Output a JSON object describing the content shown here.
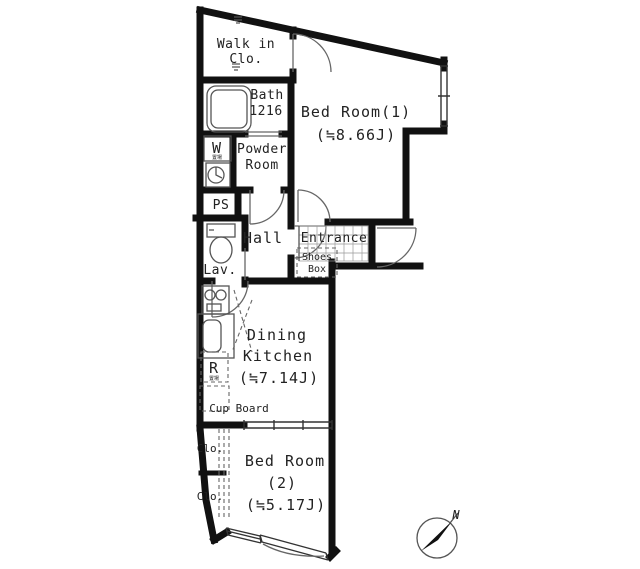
{
  "floorplan": {
    "rooms": {
      "walk_in_closet": {
        "line1": "Walk in",
        "line2": "Clo."
      },
      "bath": {
        "name": "Bath",
        "size": "1216"
      },
      "powder_room": {
        "line1": "Powder",
        "line2": "Room"
      },
      "pipe_space": "PS",
      "hall": "Hall",
      "lavatory": "Lav.",
      "entrance": "Entrance",
      "shoes_box": {
        "line1": "Shoes",
        "line2": "Box"
      },
      "bedroom1": {
        "name": "Bed Room(1)",
        "size": "(≒8.66J)"
      },
      "dining_kitchen": {
        "line1": "Dining",
        "line2": "Kitchen",
        "size": "(≒7.14J)"
      },
      "cup_board": "Cup Board",
      "bedroom2": {
        "line1": "Bed Room",
        "line2": "(2)",
        "size": "(≒5.17J)"
      },
      "closet1": "Clo.",
      "closet2": "Clo."
    },
    "fixtures": {
      "washer": "W",
      "washer_sub": "置場",
      "fridge": "R",
      "fridge_sub": "置場"
    },
    "compass": {
      "north": "N"
    },
    "colors": {
      "wall": "#111111",
      "line": "#555555",
      "text": "#222222",
      "bg": "#ffffff"
    }
  }
}
